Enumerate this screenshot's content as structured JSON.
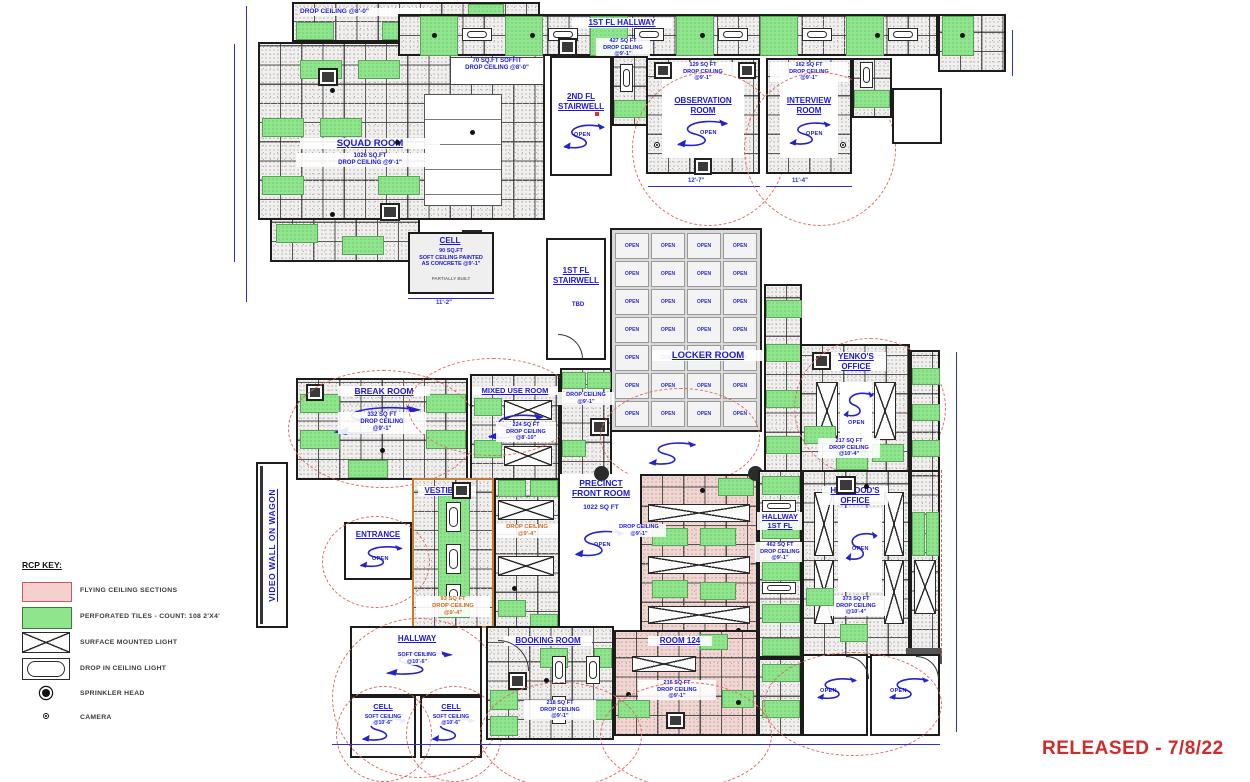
{
  "plan": {
    "released": "RELEASED - 7/8/22",
    "released_color": "#cf2b2b"
  },
  "legend": {
    "heading": "RCP KEY:",
    "flying": "FLYING CEILING SECTIONS",
    "perforated": "PERFORATED TILES - COUNT: 108 2'X4'",
    "surface_light": "SURFACE MOUNTED LIGHT",
    "drop_light": "DROP IN CEILING LIGHT",
    "sprinkler": "SPRINKLER HEAD",
    "camera": "CAMERA",
    "flying_color": "#f6cfcf",
    "perforated_color": "#8ee58c"
  },
  "rooms": {
    "top_note": "DROP CEILING @8'-0\"",
    "squad": {
      "name": "SQUAD ROOM",
      "info": "1026 SQ.FT\nDROP CEILING @9'-1\""
    },
    "soffit_note": "70 SQ.FT SOFFIT\nDROP CEILING @8'-0\"",
    "hallway_1fl": {
      "name": "1ST FL HALLWAY",
      "info": "427 SQ FT\nDROP CEILING\n@9'-1\""
    },
    "stairwell_2fl": {
      "name": "2ND FL\nSTAIRWELL",
      "open": "OPEN"
    },
    "observation": {
      "name": "OBSERVATION\nROOM",
      "info": "129 SQ FT\nDROP CEILING\n@9'-1\"",
      "open": "OPEN",
      "dim": "12'-7\""
    },
    "interview": {
      "name": "INTERVIEW\nROOM",
      "info": "162 SQ FT\nDROP CEILING\n@9'-1\"",
      "open": "OPEN",
      "dim": "11'-4\""
    },
    "cell_upper": {
      "name": "CELL",
      "info": "90 SQ.FT\nSOFT CEILING PAINTED\nAS CONCRETE @9'-1\"",
      "note": "PARTIALLY BUILT",
      "dim": "11'-2\""
    },
    "stairwell_1fl": {
      "name": "1ST FL\nSTAIRWELL",
      "status": "TBD"
    },
    "locker": {
      "name": "LOCKER ROOM",
      "cell": "OPEN",
      "count": 28
    },
    "break_room": {
      "name": "BREAK ROOM",
      "info": "332 SQ FT\nDROP CEILING\n@9'-1\""
    },
    "mixed_use": {
      "name": "MIXED USE ROOM",
      "info": "224 SQ FT\nDROP CEILING\n@8'-10\""
    },
    "mid_note": "DROP CEILING\n@9'-1\"",
    "yenko": {
      "name": "YENKO'S\nOFFICE",
      "info": "217 SQ FT\nDROP CEILING\n@10'-4\"",
      "open": "OPEN"
    },
    "vestibule": {
      "name": "VESTIBULE",
      "info": "93 SQ FT\nDROP CEILING\n@9'-4\"",
      "note": "DROP CEILING\n@9'-4\""
    },
    "entrance": {
      "name": "ENTRANCE",
      "open": "OPEN"
    },
    "precinct": {
      "name": "PRECINCT\nFRONT ROOM",
      "info": "1022 SQ FT",
      "open": "OPEN"
    },
    "flying_note": "DROP CEILING\n@9'-1\"",
    "hallway_1st": {
      "name": "HALLWAY\n1ST FL",
      "info": "462 SQ FT\nDROP CEILING\n@9'-1\""
    },
    "haywood": {
      "name": "HAYWOOD'S\nOFFICE",
      "info": "373 SQ FT\nDROP CEILING\n@10'-4\"",
      "open": "OPEN"
    },
    "hallway_cells": {
      "name": "HALLWAY",
      "info": "SOFT CEILING\n@10'-6\""
    },
    "cell_a": {
      "name": "CELL",
      "info": "SOFT CEILING\n@10'-6\""
    },
    "cell_b": {
      "name": "CELL",
      "info": "SOFT CEILING\n@10'-6\""
    },
    "booking": {
      "name": "BOOKING ROOM",
      "info": "218 SQ FT\nDROP CEILING\n@9'-1\""
    },
    "room_124": {
      "name": "ROOM 124",
      "info": "216 SQ FT\nDROP CEILING\n@9'-1\""
    },
    "open_a": "OPEN",
    "open_b": "OPEN",
    "video_wall": "VIDEO WALL ON WAGON"
  }
}
